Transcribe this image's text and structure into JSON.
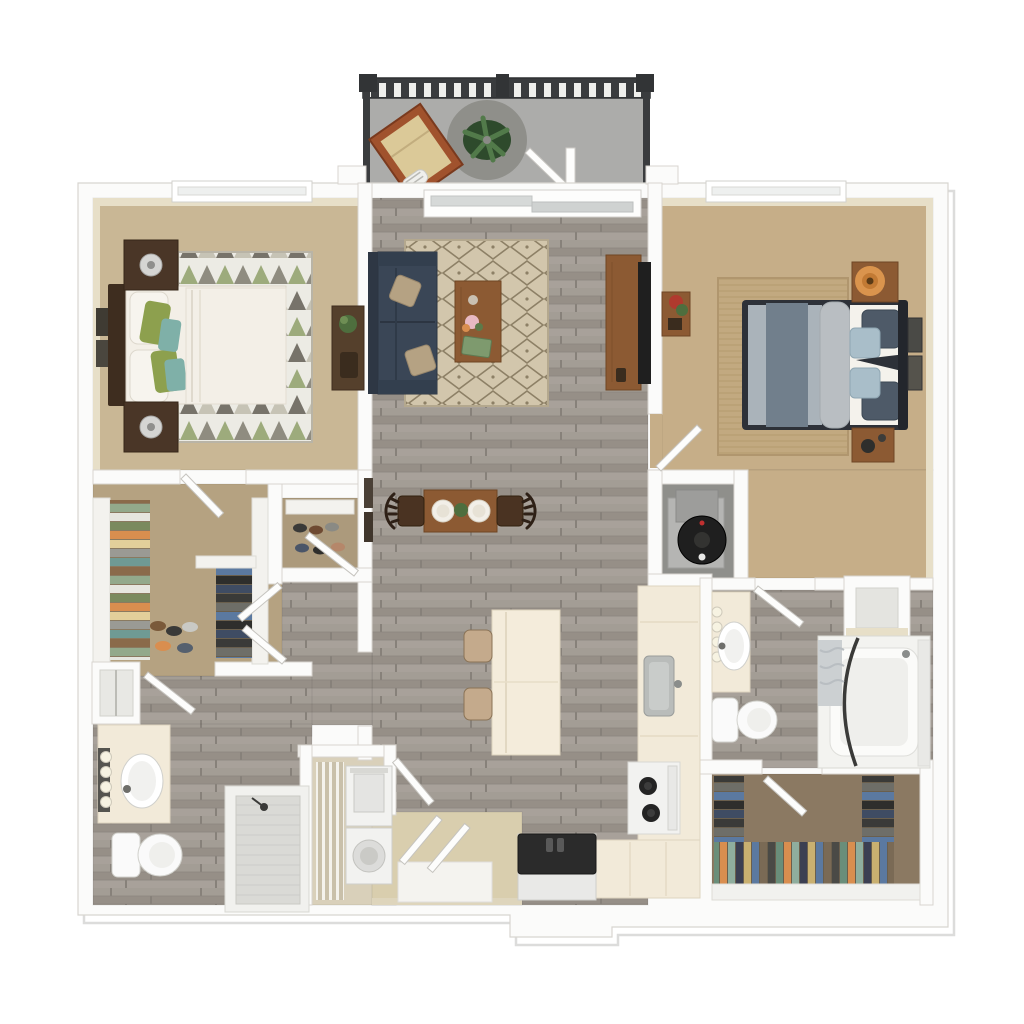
{
  "document": {
    "type": "3d-floor-plan-rendering",
    "view": "top-down",
    "units_text_visible": false,
    "background": "#ffffff"
  },
  "palette": {
    "wall": "#fbfbfa",
    "wall_edge": "#d8d5d0",
    "wall_face": "#e7dfc8",
    "carpet_bedroom1": "#c9b795",
    "carpet_bedroom2": "#c6ae88",
    "carpet_closet1": "#b5a281",
    "carpet_closet2": "#8b7962",
    "wood_floor": "#9d978f",
    "balcony_floor": "#acacaa",
    "balcony_rug": "#8f8f8a",
    "railing": "#3a3c3e",
    "sofa": "#3a4656",
    "sofa_back": "#2e3744",
    "pillow_tan": "#b5a283",
    "wood_furniture": "#8c5a33",
    "dark_wood": "#4a3627",
    "headboard": "#3e2d1f",
    "rug_living_base": "#d2c6ac",
    "rug_bedroom2": "#c2a980",
    "counter": "#f2ead9",
    "island": "#f4ecdb",
    "appliance_white": "#f2f2f0",
    "fridge_top": "#2b2b2b",
    "tv_black": "#1f1f1f",
    "water_heater": "#1f1f1f",
    "utility_floor": "#8f8f8b",
    "bedding_white": "#f3efe7",
    "bedding_gray": "#aab3ba",
    "blanket_gray": "#717f8c",
    "sheet_white": "#f4f2ec",
    "pillow_green": "#8da04e",
    "pillow_teal": "#7fb0a8",
    "pillow_navy": "#4e5a68",
    "pillow_lightblue": "#a9bec9",
    "lamp_glow": "#e29a50",
    "lamp_silver": "#d5d5d3",
    "plant_green": "#4e6e3e",
    "entry_floor": "#d9ceae",
    "mat_white": "#f4f3ef",
    "laundry_floor": "#d9d0ba",
    "tub_white": "#f3f3f0",
    "curtain_rod": "#3a3a38",
    "shower_floor": "#dadad6",
    "lounge_chair_frame": "#a0522d",
    "lounge_chair_cushion": "#dbc998"
  },
  "rooms": [
    {
      "id": "balcony",
      "name": "Balcony",
      "floor": "concrete",
      "items": [
        "railing",
        "lounge-chair",
        "round-rug",
        "potted-plant",
        "open-door"
      ]
    },
    {
      "id": "bedroom-1",
      "name": "Bedroom 1",
      "floor": "carpet",
      "items": [
        "queen-bed",
        "nightstand-upper",
        "nightstand-lower",
        "table-lamps",
        "geometric-rug",
        "desk-with-plant",
        "wall-art",
        "window"
      ]
    },
    {
      "id": "living-room",
      "name": "Living Room",
      "floor": "wood",
      "items": [
        "sofa",
        "throw-pillows",
        "diamond-rug",
        "coffee-table",
        "tv-console",
        "tv"
      ]
    },
    {
      "id": "dining-area",
      "name": "Dining Area",
      "floor": "wood",
      "items": [
        "dining-table",
        "two-chairs",
        "two-place-settings",
        "centerpiece"
      ]
    },
    {
      "id": "kitchen",
      "name": "Kitchen",
      "floor": "wood",
      "items": [
        "island",
        "two-bar-stools",
        "sink",
        "range-stove",
        "refrigerator",
        "counters"
      ]
    },
    {
      "id": "bedroom-2",
      "name": "Bedroom 2",
      "floor": "carpet",
      "items": [
        "queen-bed",
        "nightstand-with-lit-lamp",
        "nightstand-lower",
        "jute-rug",
        "wall-art",
        "plant-shelf",
        "window"
      ]
    },
    {
      "id": "walk-in-closet-1",
      "name": "Walk-in Closet 1",
      "floor": "carpet",
      "items": [
        "hanging-clothes",
        "shoe-shelves"
      ]
    },
    {
      "id": "reach-in-closet",
      "name": "Reach-in Closet",
      "floor": "carpet",
      "items": [
        "shoe-shelves"
      ]
    },
    {
      "id": "bathroom-1",
      "name": "Bathroom 1",
      "floor": "wood",
      "items": [
        "vanity-sink",
        "vanity-lights",
        "toilet",
        "walk-in-shower",
        "linen-closet"
      ]
    },
    {
      "id": "laundry-closet",
      "name": "Laundry Closet",
      "floor": "vinyl",
      "items": [
        "wire-shelving",
        "stacked-washer-dryer"
      ]
    },
    {
      "id": "utility-closet",
      "name": "Utility Closet",
      "floor": "concrete",
      "items": [
        "water-heater",
        "furnace"
      ]
    },
    {
      "id": "bathroom-2",
      "name": "Bathroom 2",
      "floor": "wood",
      "items": [
        "vanity-sink",
        "vanity-lights",
        "toilet",
        "bathtub",
        "shower-curtain-rod",
        "linen-closet"
      ]
    },
    {
      "id": "walk-in-closet-2",
      "name": "Walk-in Closet 2",
      "floor": "carpet",
      "items": [
        "hanging-clothes",
        "shoe-shelves"
      ]
    },
    {
      "id": "entry",
      "name": "Entry",
      "floor": "tile",
      "items": [
        "door-mat",
        "double-doors"
      ]
    }
  ]
}
